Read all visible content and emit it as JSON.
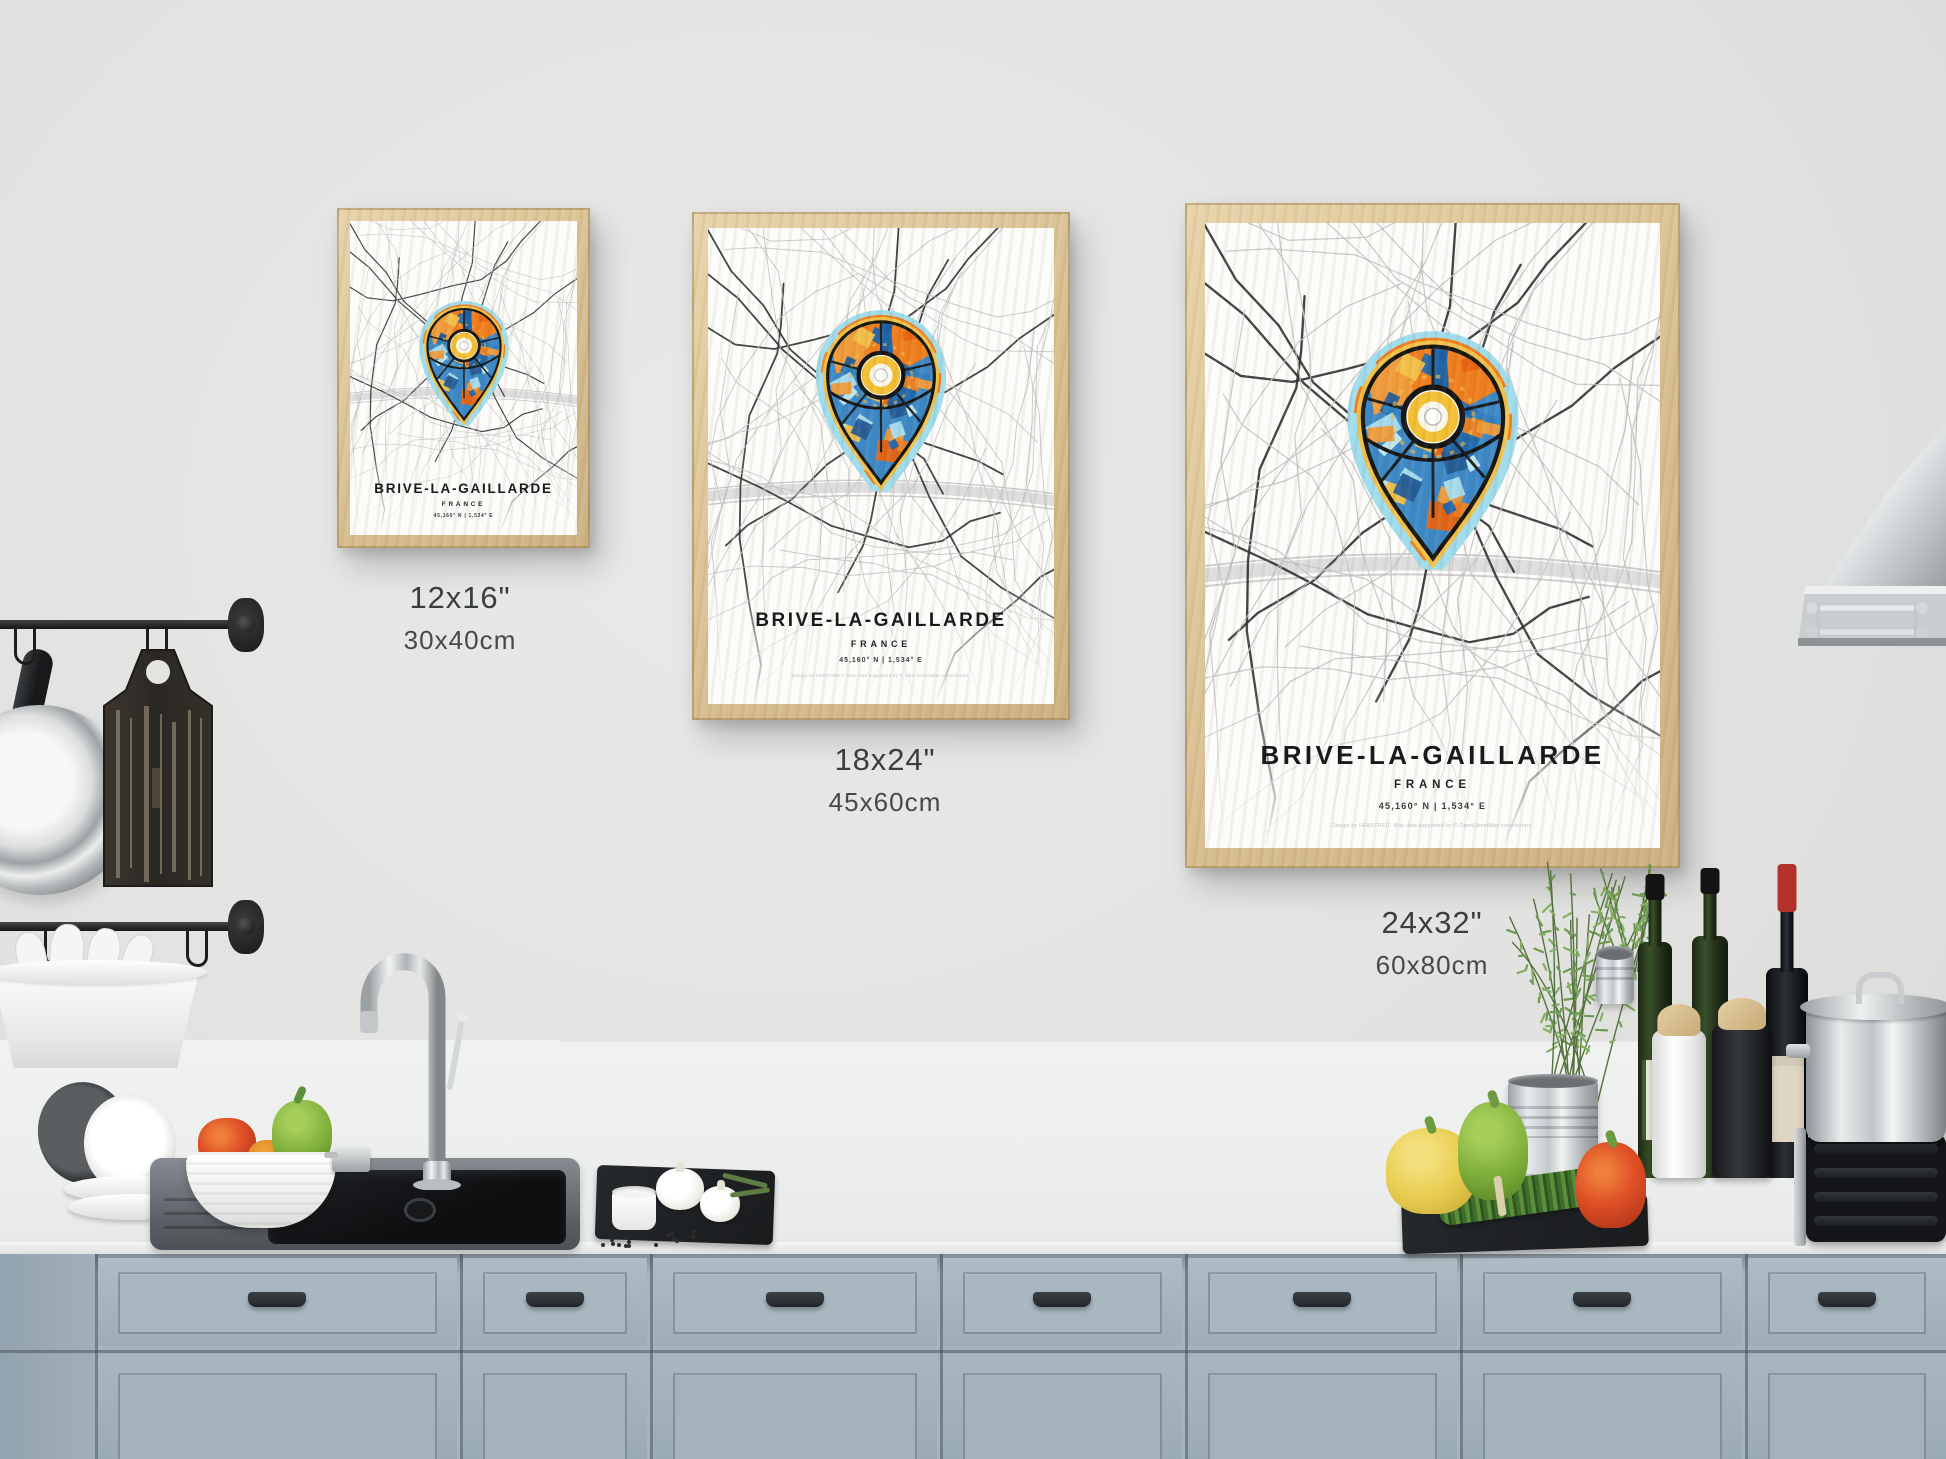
{
  "posters": [
    {
      "id": "small",
      "title": "BRIVE-LA-GAILLARDE",
      "country": "FRANCE",
      "coordinates": "45,160° N | 1,534° E",
      "size_inches": "12x16\"",
      "size_cm": "30x40cm"
    },
    {
      "id": "medium",
      "title": "BRIVE-LA-GAILLARDE",
      "country": "FRANCE",
      "coordinates": "45,160° N | 1,534° E",
      "size_inches": "18x24\"",
      "size_cm": "45x60cm",
      "credit": "Design by HEBSTREIT. Map data supported by © OpenStreetMap contributors."
    },
    {
      "id": "large",
      "title": "BRIVE-LA-GAILLARDE",
      "country": "FRANCE",
      "coordinates": "45,160° N | 1,534° E",
      "size_inches": "24x32\"",
      "size_cm": "60x80cm",
      "credit": "Design by HEBSTREIT. Map data supported by © OpenStreetMap contributors."
    }
  ],
  "colors": {
    "wall": "#e4e5e3",
    "counter": "#eef0ef",
    "cabinet": "#a6b4bd",
    "frame_wood": "#ddc59d",
    "pin_orange": "#ee7d1d",
    "pin_blue": "#2f7fc0",
    "pin_yellow": "#f2c14b",
    "pin_aqua": "#9fdcec"
  }
}
